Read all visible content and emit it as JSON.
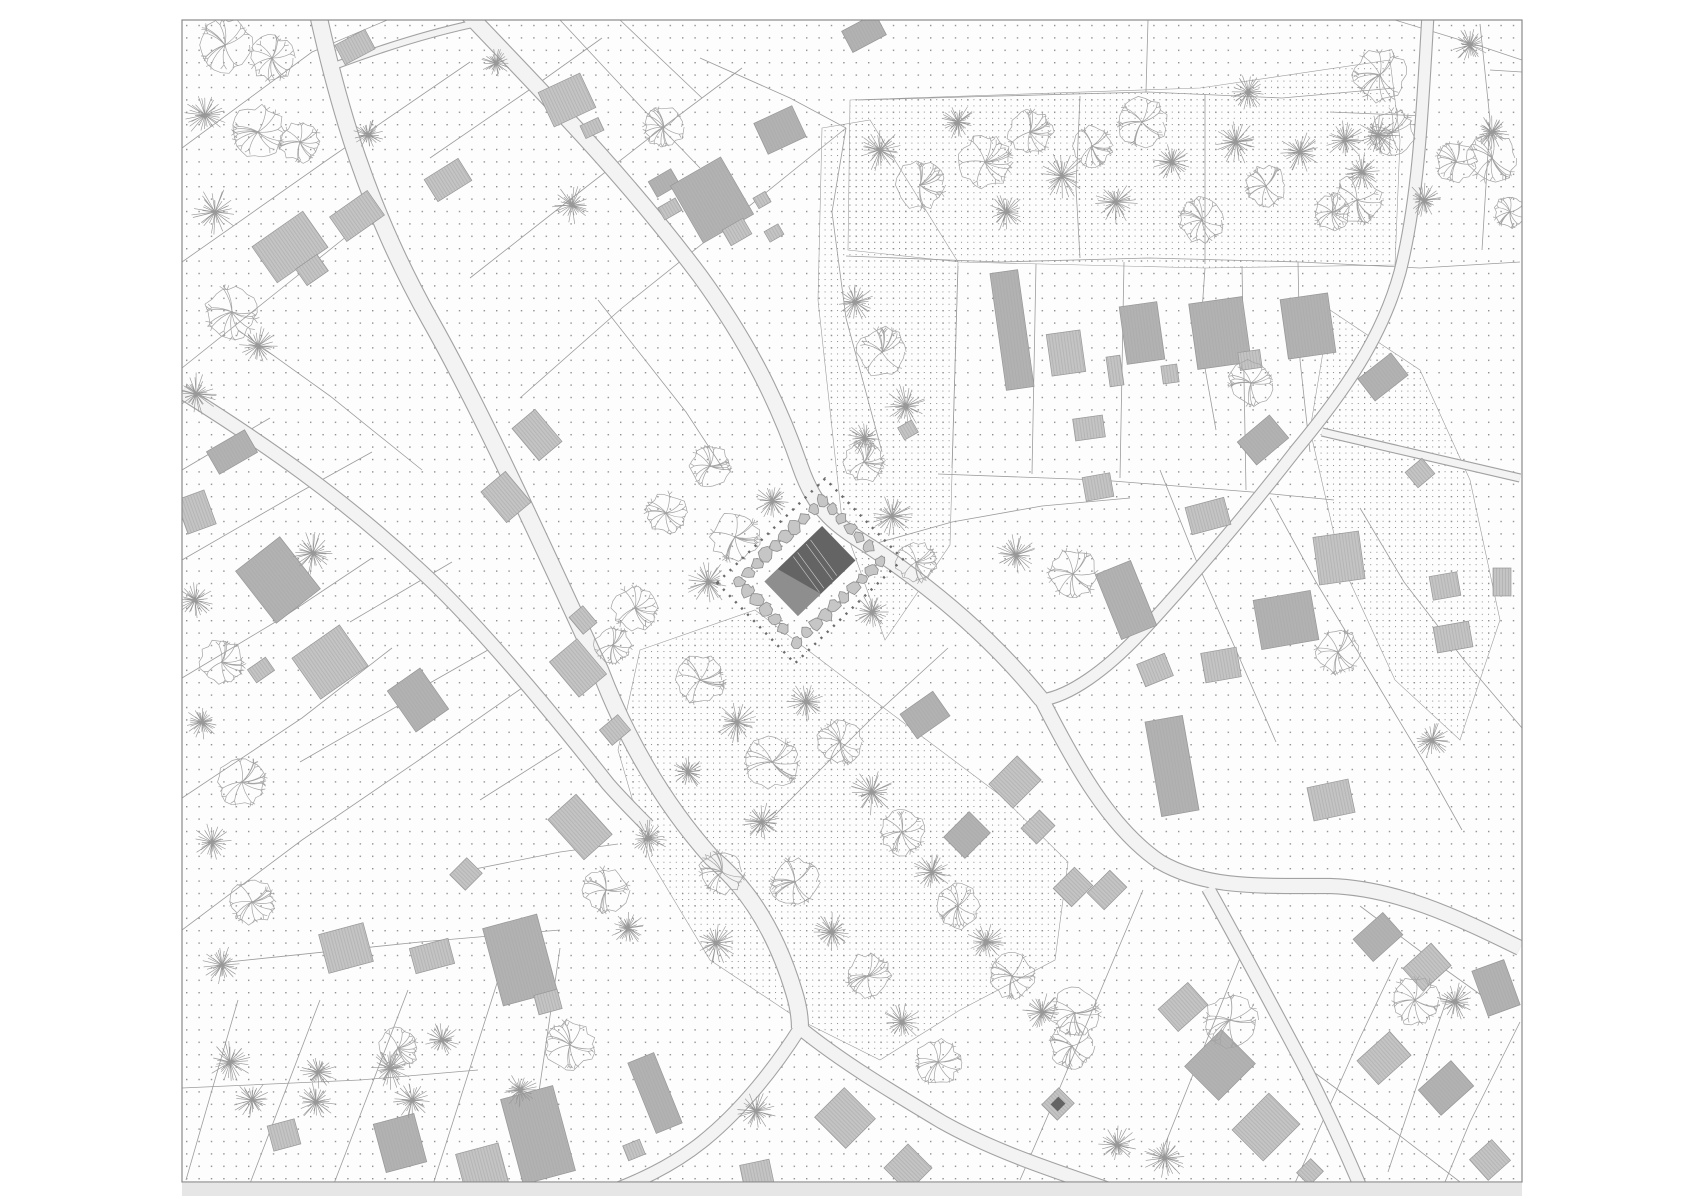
{
  "canvas": {
    "w": 1700,
    "h": 1202
  },
  "plan": {
    "x": 182,
    "y": 20,
    "w": 1340,
    "h": 1162
  },
  "colors": {
    "page_bg": "#ffffff",
    "plan_bg": "#fdfdfd",
    "plan_border": "#8a8a8a",
    "dot": "#8f8f8f",
    "dot_dense": "#8c8c8c",
    "parcel": "#9c9c9c",
    "road_fill": "#f3f3f3",
    "road_edge": "#a2a2a2",
    "building_fill": "#c4c4c4",
    "building_fill_dark": "#b2b2b2",
    "building_hatch": "#a9a9a9",
    "building_stroke": "#979797",
    "tree_deciduous": "#a3a3a3",
    "tree_conifer": "#989898",
    "site_roof_dark": "#646464",
    "site_roof_light": "#8e8e8e",
    "site_ridge": "#e8e8e8",
    "hedge_fill": "#c6c6c6",
    "hedge_stroke": "#8d8d8d",
    "boundary_dots": "#6b6b6b",
    "shadow_strip": "#e6e6e6"
  },
  "dots": {
    "spacing": 12.4,
    "size": 1.4,
    "dense_spacing": 6.2,
    "dense_size": 1.0
  },
  "roads": [
    {
      "d": "M 318,14 C 338,104 366,206 430,320 C 482,412 540,540 600,670 C 626,738 662,802 712,858 C 748,888 776,932 794,992 C 799,1008 800,1018 800,1028",
      "w": 16
    },
    {
      "d": "M 182,392 C 262,442 342,497 422,572 C 472,618 542,700 608,784 C 622,800 634,812 648,826",
      "w": 13
    },
    {
      "d": "M 468,14 C 542,92 622,172 700,276 C 748,342 778,402 800,466 C 816,512 836,525 872,548 C 932,588 992,638 1042,700",
      "w": 15
    },
    {
      "d": "M 1042,700 C 1075,765 1110,828 1160,862 C 1205,888 1255,886 1330,886 C 1395,888 1455,916 1520,948",
      "w": 14
    },
    {
      "d": "M 1208,888 C 1238,942 1268,998 1302,1062 C 1326,1108 1350,1162 1366,1200",
      "w": 12
    },
    {
      "d": "M 800,1028 C 842,1062 892,1092 942,1122 C 992,1150 1045,1168 1128,1196",
      "w": 13
    },
    {
      "d": "M 800,1028 C 776,1066 742,1110 702,1142 C 672,1166 638,1182 596,1197",
      "w": 12
    },
    {
      "d": "M 1428,14 C 1422,120 1418,200 1400,272 C 1382,338 1344,392 1296,450 C 1248,512 1190,580 1140,634 C 1106,670 1070,696 1042,700",
      "w": 11
    },
    {
      "d": "M 1322,432 C 1390,448 1452,462 1520,478",
      "w": 7
    },
    {
      "d": "M 334,66 C 382,48 432,32 482,22",
      "w": 6
    }
  ],
  "parcels": [
    "182,148 312,52 392,18",
    "182,262 330,158 470,62",
    "182,368 282,288 362,224",
    "238,330 330,396 422,470",
    "470,278 572,198 662,128 742,68",
    "520,398 622,308 722,228 846,128",
    "430,158 532,88 602,38",
    "182,470 270,418",
    "182,560 300,492 372,452",
    "182,678 282,618 372,558",
    "182,798 302,718 392,648",
    "182,930 302,840 422,758 522,688",
    "238,1000 186,1180",
    "320,1000 246,1194",
    "408,990 330,1194",
    "498,980 430,1194",
    "182,1088 360,1080 478,1070",
    "228,962 420,942 560,930",
    "560,948 524,1194",
    "620,20 702,98",
    "560,20 642,108 700,168",
    "700,58 790,98 846,128",
    "846,128 832,212 846,318 882,452",
    "858,100 1000,96 1148,92 1282,98 1395,88",
    "846,256 1000,262 1150,258 1300,262 1420,268 1520,262",
    "1080,96 1076,188 1080,258",
    "1205,94 1205,264",
    "1148,20 1146,92",
    "958,266 952,468",
    "1036,264 1032,474",
    "1124,262 1120,478",
    "1242,266 1246,490",
    "938,474 1100,480 1252,492 1334,500",
    "1395,20 1480,46 1522,60",
    "1480,24 1490,120 1482,250",
    "1490,70 1522,72",
    "1330,112 1424,116",
    "1160,470 1196,560 1236,650 1276,742",
    "1270,498 1316,582 1364,662 1424,762 1462,830",
    "1360,508 1404,582 1464,660 1522,728",
    "870,545 952,522 1042,506 1130,498",
    "948,648 878,712 808,782 758,832",
    "1143,890 1100,992 1058,1092 1020,1180",
    "1240,958 1198,1062 1158,1162",
    "1398,958 1358,1042 1318,1132 1290,1194",
    "1448,996 1418,1082 1388,1172",
    "1520,1022 1470,1122 1440,1194",
    "1360,906 1432,960 1502,1010",
    "1300,1062 1382,1122 1460,1182",
    "460,872 560,852 618,844",
    "350,622 452,562",
    "400,700 502,642",
    "300,762 422,692",
    "480,800 562,748",
    "598,300 642,356 686,412 724,470",
    "1205,268 1200,340 1216,430",
    "1298,262 1300,360 1310,452"
  ],
  "dense_zones": [
    "850,100 1200,88 1390,60 1400,140 1395,265 1205,268 960,262 848,250",
    "822,128 870,120 958,262 950,545 885,640 842,520 818,300",
    "640,650 755,610 880,705 1000,795 1068,862 1055,960 960,1010 880,1060 800,1020 710,960 650,860 618,750",
    "1330,310 1420,370 1470,480 1500,620 1460,740 1395,680 1340,560 1310,430"
  ],
  "buildings": [
    [
      355,
      47,
      34,
      22,
      -28,
      0
    ],
    [
      567,
      100,
      46,
      38,
      -25,
      0
    ],
    [
      592,
      128,
      20,
      14,
      -25,
      0
    ],
    [
      448,
      180,
      40,
      26,
      -32,
      0
    ],
    [
      357,
      216,
      46,
      30,
      -35,
      0
    ],
    [
      290,
      247,
      62,
      44,
      -35,
      0
    ],
    [
      312,
      270,
      26,
      20,
      -35,
      0
    ],
    [
      664,
      183,
      26,
      18,
      -30,
      1
    ],
    [
      670,
      209,
      20,
      14,
      -30,
      0
    ],
    [
      712,
      200,
      58,
      66,
      -30,
      1
    ],
    [
      737,
      232,
      24,
      18,
      -30,
      0
    ],
    [
      762,
      200,
      14,
      12,
      -30,
      0
    ],
    [
      774,
      233,
      16,
      12,
      -30,
      0
    ],
    [
      780,
      130,
      42,
      34,
      -25,
      1
    ],
    [
      864,
      33,
      38,
      24,
      -28,
      1
    ],
    [
      232,
      452,
      44,
      26,
      -30,
      1
    ],
    [
      196,
      512,
      30,
      36,
      -20,
      0
    ],
    [
      278,
      580,
      56,
      66,
      -38,
      1
    ],
    [
      261,
      670,
      22,
      16,
      -35,
      0
    ],
    [
      330,
      662,
      58,
      50,
      -35,
      0
    ],
    [
      418,
      700,
      40,
      50,
      -35,
      1
    ],
    [
      537,
      435,
      30,
      42,
      -40,
      0
    ],
    [
      506,
      497,
      32,
      40,
      -40,
      0
    ],
    [
      578,
      668,
      36,
      46,
      -40,
      0
    ],
    [
      615,
      730,
      24,
      20,
      -40,
      0
    ],
    [
      583,
      620,
      18,
      22,
      -40,
      0
    ],
    [
      346,
      948,
      46,
      40,
      -15,
      0
    ],
    [
      432,
      956,
      40,
      26,
      -15,
      0
    ],
    [
      520,
      960,
      56,
      80,
      -15,
      1
    ],
    [
      548,
      1002,
      24,
      20,
      -15,
      0
    ],
    [
      538,
      1135,
      54,
      88,
      -15,
      1
    ],
    [
      580,
      827,
      38,
      54,
      -42,
      0
    ],
    [
      284,
      1135,
      28,
      26,
      -15,
      0
    ],
    [
      400,
      1143,
      42,
      50,
      -15,
      1
    ],
    [
      482,
      1168,
      44,
      40,
      -15,
      0
    ],
    [
      466,
      874,
      24,
      22,
      -45,
      0
    ],
    [
      655,
      1093,
      28,
      76,
      -22,
      1
    ],
    [
      634,
      1150,
      18,
      16,
      -22,
      0
    ],
    [
      845,
      1118,
      42,
      44,
      -45,
      0
    ],
    [
      908,
      1168,
      34,
      34,
      -45,
      0
    ],
    [
      757,
      1175,
      30,
      26,
      -12,
      0
    ],
    [
      1015,
      782,
      40,
      34,
      -45,
      0
    ],
    [
      967,
      835,
      36,
      30,
      -45,
      1
    ],
    [
      1038,
      827,
      26,
      22,
      -45,
      0
    ],
    [
      1073,
      887,
      30,
      26,
      -45,
      0
    ],
    [
      1058,
      1104,
      24,
      22,
      -45,
      0
    ],
    [
      1012,
      330,
      28,
      118,
      -8,
      1
    ],
    [
      1066,
      353,
      34,
      42,
      -8,
      0
    ],
    [
      1115,
      371,
      14,
      30,
      -8,
      0
    ],
    [
      1142,
      333,
      38,
      58,
      -8,
      1
    ],
    [
      1170,
      374,
      16,
      18,
      -8,
      0
    ],
    [
      1220,
      333,
      54,
      66,
      -8,
      1
    ],
    [
      1250,
      360,
      22,
      18,
      -8,
      0
    ],
    [
      1308,
      326,
      48,
      60,
      -8,
      1
    ],
    [
      1375,
      388,
      14,
      16,
      -40,
      0
    ],
    [
      1089,
      428,
      30,
      22,
      -8,
      0
    ],
    [
      1098,
      487,
      28,
      24,
      -10,
      0
    ],
    [
      1263,
      440,
      42,
      30,
      -40,
      1
    ],
    [
      1208,
      516,
      40,
      28,
      -15,
      0
    ],
    [
      1339,
      558,
      46,
      48,
      -8,
      0
    ],
    [
      1286,
      620,
      58,
      50,
      -10,
      1
    ],
    [
      1126,
      600,
      38,
      70,
      -22,
      1
    ],
    [
      1155,
      670,
      30,
      24,
      -22,
      0
    ],
    [
      1221,
      665,
      36,
      30,
      -10,
      0
    ],
    [
      1172,
      766,
      38,
      96,
      -10,
      1
    ],
    [
      1331,
      800,
      42,
      34,
      -12,
      0
    ],
    [
      1445,
      586,
      28,
      24,
      -10,
      0
    ],
    [
      1453,
      637,
      36,
      26,
      -10,
      0
    ],
    [
      1420,
      473,
      22,
      20,
      -40,
      0
    ],
    [
      1383,
      377,
      42,
      28,
      -38,
      1
    ],
    [
      1502,
      582,
      18,
      28,
      0,
      0
    ],
    [
      1378,
      937,
      40,
      30,
      -42,
      1
    ],
    [
      1427,
      967,
      38,
      30,
      -42,
      0
    ],
    [
      1496,
      988,
      34,
      48,
      -20,
      1
    ],
    [
      1384,
      1058,
      44,
      32,
      -42,
      0
    ],
    [
      1446,
      1088,
      44,
      34,
      -42,
      1
    ],
    [
      1490,
      1160,
      30,
      28,
      -42,
      0
    ],
    [
      1183,
      1007,
      40,
      30,
      -42,
      0
    ],
    [
      1220,
      1065,
      52,
      48,
      -45,
      1
    ],
    [
      1266,
      1127,
      52,
      44,
      -45,
      0
    ],
    [
      1310,
      1172,
      20,
      18,
      -45,
      0
    ],
    [
      1107,
      890,
      32,
      24,
      -45,
      0
    ],
    [
      908,
      430,
      16,
      14,
      -30,
      0
    ],
    [
      925,
      715,
      40,
      30,
      -35,
      1
    ]
  ],
  "building_extras": [
    {
      "x": 1058,
      "y": 1104,
      "w": 11,
      "h": 10,
      "r": -45,
      "fill": "site_roof_dark"
    }
  ],
  "trees": [
    [
      225,
      45,
      26,
      "d"
    ],
    [
      272,
      58,
      22,
      "d"
    ],
    [
      205,
      115,
      22,
      "c"
    ],
    [
      258,
      132,
      26,
      "d"
    ],
    [
      300,
      142,
      20,
      "d"
    ],
    [
      215,
      212,
      24,
      "c"
    ],
    [
      232,
      312,
      26,
      "d"
    ],
    [
      258,
      346,
      20,
      "c"
    ],
    [
      196,
      394,
      22,
      "c"
    ],
    [
      313,
      553,
      22,
      "c"
    ],
    [
      496,
      63,
      15,
      "c"
    ],
    [
      664,
      127,
      20,
      "d"
    ],
    [
      572,
      205,
      20,
      "c"
    ],
    [
      368,
      135,
      16,
      "c"
    ],
    [
      666,
      513,
      20,
      "d"
    ],
    [
      635,
      608,
      22,
      "d"
    ],
    [
      613,
      645,
      18,
      "d"
    ],
    [
      708,
      582,
      24,
      "c"
    ],
    [
      735,
      537,
      24,
      "d"
    ],
    [
      772,
      501,
      18,
      "c"
    ],
    [
      710,
      466,
      20,
      "d"
    ],
    [
      865,
      438,
      18,
      "c"
    ],
    [
      880,
      150,
      22,
      "c"
    ],
    [
      920,
      185,
      24,
      "d"
    ],
    [
      958,
      122,
      18,
      "c"
    ],
    [
      985,
      162,
      26,
      "d"
    ],
    [
      1006,
      212,
      20,
      "c"
    ],
    [
      1030,
      132,
      22,
      "d"
    ],
    [
      1062,
      176,
      24,
      "c"
    ],
    [
      1092,
      146,
      20,
      "d"
    ],
    [
      1116,
      202,
      22,
      "c"
    ],
    [
      1142,
      122,
      24,
      "d"
    ],
    [
      1172,
      162,
      20,
      "c"
    ],
    [
      1202,
      220,
      22,
      "d"
    ],
    [
      1236,
      142,
      24,
      "c"
    ],
    [
      1266,
      186,
      20,
      "d"
    ],
    [
      1300,
      152,
      22,
      "c"
    ],
    [
      1332,
      212,
      18,
      "d"
    ],
    [
      1362,
      172,
      20,
      "c"
    ],
    [
      1392,
      132,
      22,
      "d"
    ],
    [
      1424,
      200,
      18,
      "c"
    ],
    [
      1456,
      162,
      20,
      "d"
    ],
    [
      1492,
      132,
      18,
      "c"
    ],
    [
      1510,
      212,
      16,
      "d"
    ],
    [
      1248,
      92,
      18,
      "c"
    ],
    [
      855,
      302,
      20,
      "c"
    ],
    [
      882,
      352,
      24,
      "d"
    ],
    [
      906,
      406,
      22,
      "c"
    ],
    [
      864,
      462,
      20,
      "d"
    ],
    [
      892,
      516,
      22,
      "c"
    ],
    [
      916,
      562,
      20,
      "d"
    ],
    [
      872,
      612,
      18,
      "c"
    ],
    [
      700,
      680,
      24,
      "d"
    ],
    [
      737,
      722,
      22,
      "c"
    ],
    [
      772,
      762,
      26,
      "d"
    ],
    [
      806,
      702,
      20,
      "c"
    ],
    [
      840,
      742,
      22,
      "d"
    ],
    [
      872,
      792,
      24,
      "c"
    ],
    [
      902,
      832,
      22,
      "d"
    ],
    [
      932,
      872,
      20,
      "c"
    ],
    [
      958,
      906,
      22,
      "d"
    ],
    [
      986,
      942,
      20,
      "c"
    ],
    [
      1012,
      976,
      22,
      "d"
    ],
    [
      1042,
      1012,
      20,
      "c"
    ],
    [
      1072,
      1046,
      22,
      "d"
    ],
    [
      762,
      822,
      20,
      "c"
    ],
    [
      722,
      872,
      22,
      "d"
    ],
    [
      795,
      882,
      24,
      "d"
    ],
    [
      832,
      932,
      20,
      "c"
    ],
    [
      868,
      976,
      22,
      "d"
    ],
    [
      902,
      1022,
      20,
      "c"
    ],
    [
      938,
      1062,
      22,
      "d"
    ],
    [
      648,
      838,
      20,
      "c"
    ],
    [
      606,
      890,
      22,
      "d"
    ],
    [
      628,
      928,
      18,
      "c"
    ],
    [
      716,
      943,
      22,
      "c"
    ],
    [
      756,
      1111,
      20,
      "c"
    ],
    [
      688,
      772,
      18,
      "c"
    ],
    [
      195,
      600,
      20,
      "c"
    ],
    [
      222,
      662,
      22,
      "d"
    ],
    [
      202,
      722,
      18,
      "c"
    ],
    [
      242,
      782,
      24,
      "d"
    ],
    [
      212,
      842,
      20,
      "c"
    ],
    [
      252,
      902,
      22,
      "d"
    ],
    [
      222,
      965,
      20,
      "c"
    ],
    [
      230,
      1062,
      22,
      "c"
    ],
    [
      252,
      1100,
      20,
      "c"
    ],
    [
      318,
      1072,
      18,
      "c"
    ],
    [
      316,
      1102,
      20,
      "c"
    ],
    [
      390,
      1068,
      22,
      "c"
    ],
    [
      412,
      1100,
      20,
      "c"
    ],
    [
      442,
      1040,
      18,
      "c"
    ],
    [
      398,
      1048,
      20,
      "d"
    ],
    [
      570,
      1045,
      24,
      "d"
    ],
    [
      520,
      1090,
      18,
      "c"
    ],
    [
      1251,
      383,
      22,
      "d"
    ],
    [
      1075,
      1013,
      24,
      "d"
    ],
    [
      1230,
      1020,
      26,
      "d"
    ],
    [
      1415,
      1000,
      24,
      "d"
    ],
    [
      1455,
      1002,
      20,
      "c"
    ],
    [
      1117,
      1145,
      20,
      "c"
    ],
    [
      1165,
      1158,
      22,
      "c"
    ],
    [
      1380,
      75,
      26,
      "d"
    ],
    [
      1378,
      135,
      22,
      "c"
    ],
    [
      1345,
      140,
      20,
      "c"
    ],
    [
      1492,
      158,
      24,
      "d"
    ],
    [
      1357,
      200,
      24,
      "d"
    ],
    [
      1432,
      740,
      20,
      "c"
    ],
    [
      1338,
      652,
      22,
      "d"
    ],
    [
      1073,
      574,
      24,
      "d"
    ],
    [
      1016,
      555,
      22,
      "c"
    ],
    [
      1470,
      45,
      18,
      "c"
    ]
  ],
  "site": {
    "cx": 810,
    "cy": 571,
    "rot": -44,
    "building_w": 80,
    "building_h": 48,
    "wedge": "-40,-24 -40,24 -8,24 -22,-24",
    "ridges": [
      [
        -2,
        4
      ],
      [
        16,
        22
      ]
    ],
    "hedge_w": 118,
    "hedge_h": 84,
    "boundary_w": 150,
    "boundary_h": 112
  },
  "shadow_strip": {
    "x": 182,
    "y": 1183,
    "w": 1340,
    "h": 13
  }
}
